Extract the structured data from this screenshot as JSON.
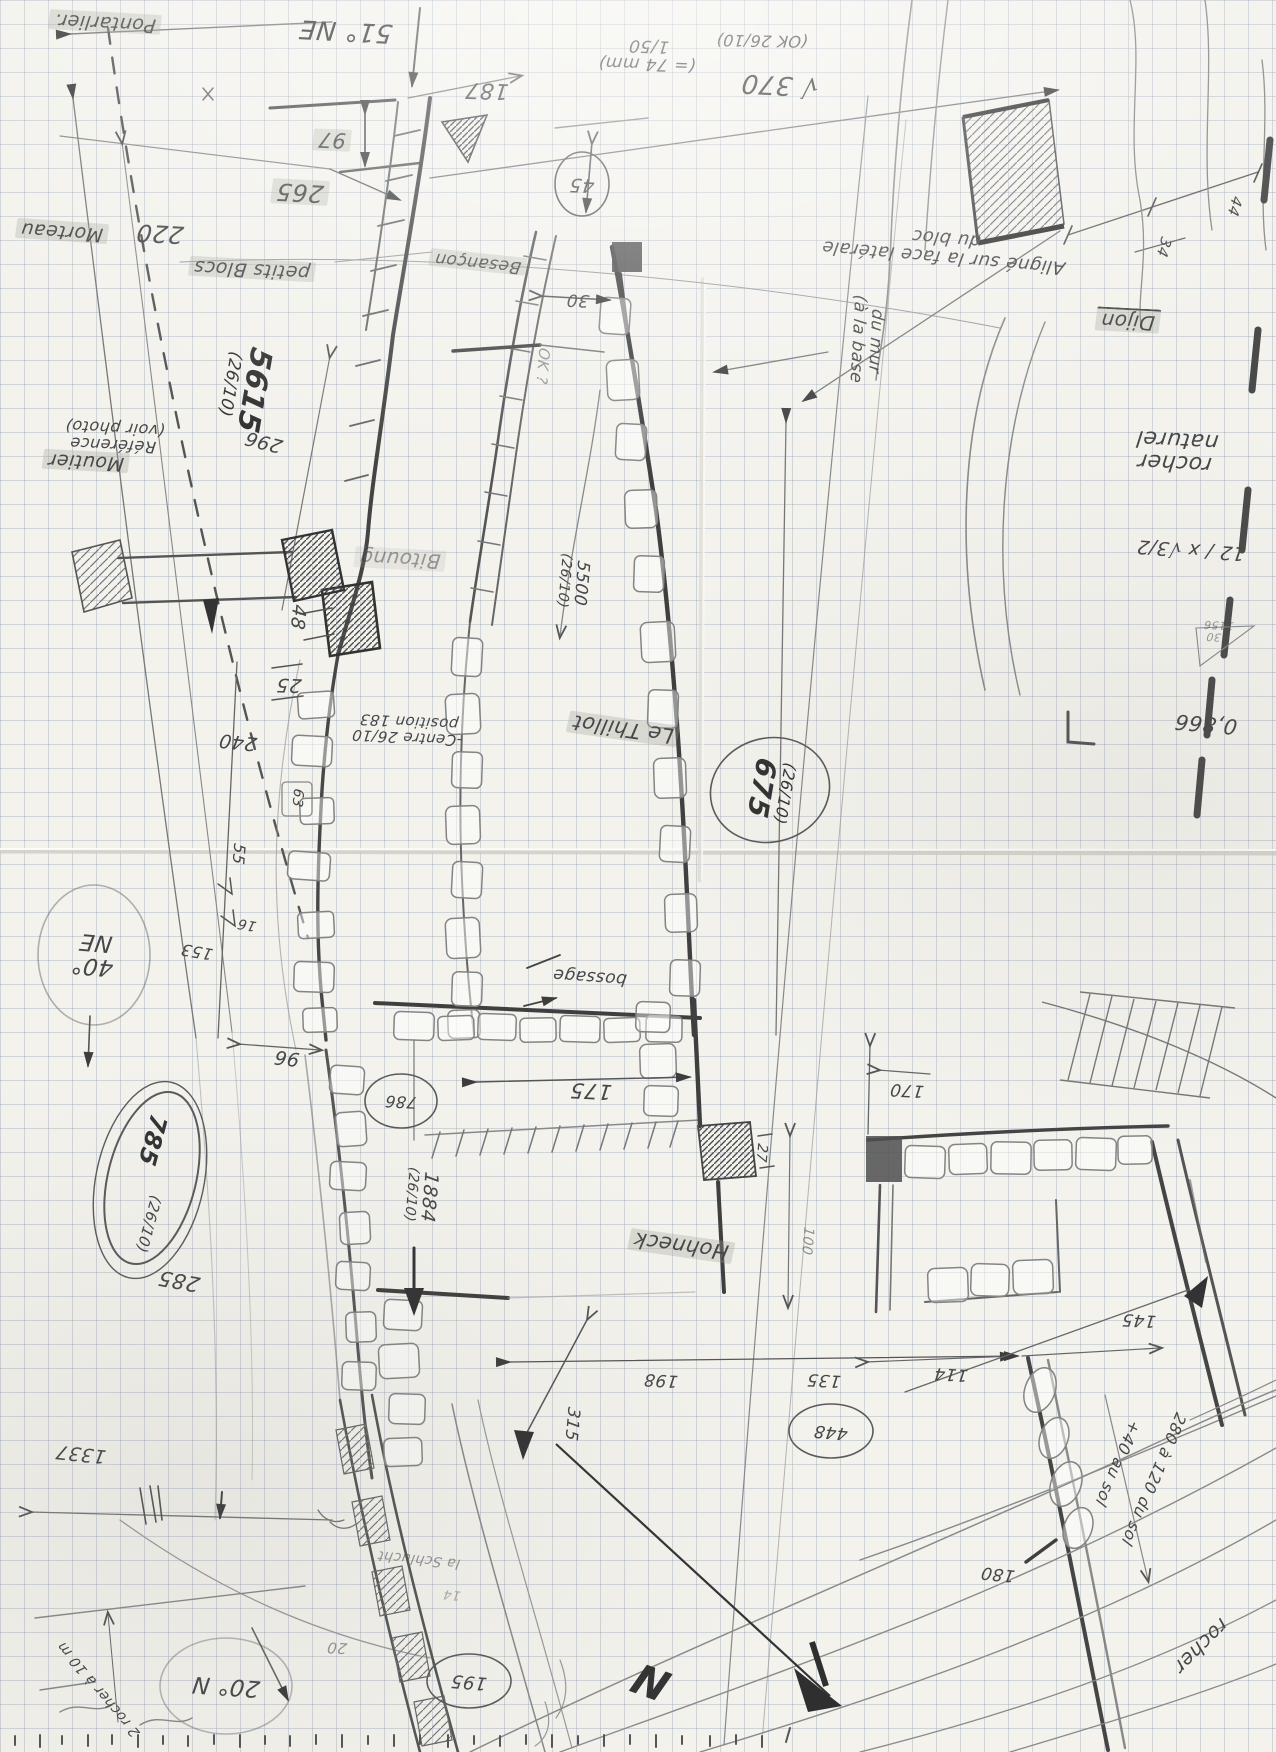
{
  "colors": {
    "pencil": "#4a4a4a",
    "pencil_dark": "#383838",
    "grid": "#94a2b2",
    "paper": "#f3f2ed",
    "highlight": "rgba(158,158,150,0.30)"
  },
  "labels": {
    "pontarlier": "Pontarlier.",
    "bearing51": "51° NE",
    "d187": "187",
    "d97": "97",
    "d265": "265",
    "d220": "220",
    "morteau": "Morteau",
    "scale1": "(= 74 mm)",
    "scale2": "1/50",
    "ok2610": "(OK 26/10)",
    "d370": "√ 370",
    "aligne1": "Aligné sur la face latérale",
    "aligne2": "du bloc",
    "dijon": "Dijon",
    "d44": "44",
    "d34": "34",
    "petits_blocs": "petits Blocs",
    "besancon": "Besançon",
    "d45": "45",
    "d30": "30",
    "ok_q": "OK ?",
    "d5615": "5615",
    "d5615b": "(26/10)",
    "reference1": "Référence",
    "reference2": "(voir photo)",
    "d296": "296",
    "moutier": "Moutier",
    "d48": "48",
    "bitoung": "Bitoung",
    "d25": "25",
    "centre1": "-Centre 26/10",
    "centre2": "position 183",
    "le_thillot": "Le Thillot",
    "d5500": "5500",
    "d5500b": "(26/10)",
    "d675": "675",
    "d675b": "(26/10)",
    "bossage": "bossage",
    "b40a": "40°",
    "b40b": "NE",
    "d153": "153",
    "d16": "16",
    "d55": "55",
    "d63": "63",
    "d240": "240",
    "d96": "96",
    "d786": "786",
    "d175": "175",
    "d1884": "1884",
    "d1884b": "(26/10)",
    "hohneck": "Hohneck",
    "d27": "27",
    "d100": "100",
    "d198": "198",
    "d135": "135",
    "d315": "315",
    "d114": "114",
    "d145": "145",
    "d170": "170",
    "d448": "448",
    "d280": "280 à 120 du sol",
    "d40sol": "+40 au sol",
    "d180": "180",
    "rocher_se": "rocher",
    "bearing20": "20° N",
    "rocher10m": "2 rocher à 10 m",
    "d195": "195",
    "d20": "20",
    "schlucht": "la Schlucht",
    "rocher_nat1": "rocher",
    "rocher_nat2": "naturel",
    "calc1": "12 / x √3/2",
    "calc2": "0,866",
    "frac_a": "530",
    "frac_b": "1156",
    "d1337": "1337",
    "d285": "285",
    "d785": "785",
    "d785b": "(26/10)",
    "d14": "14",
    "north": "N"
  }
}
